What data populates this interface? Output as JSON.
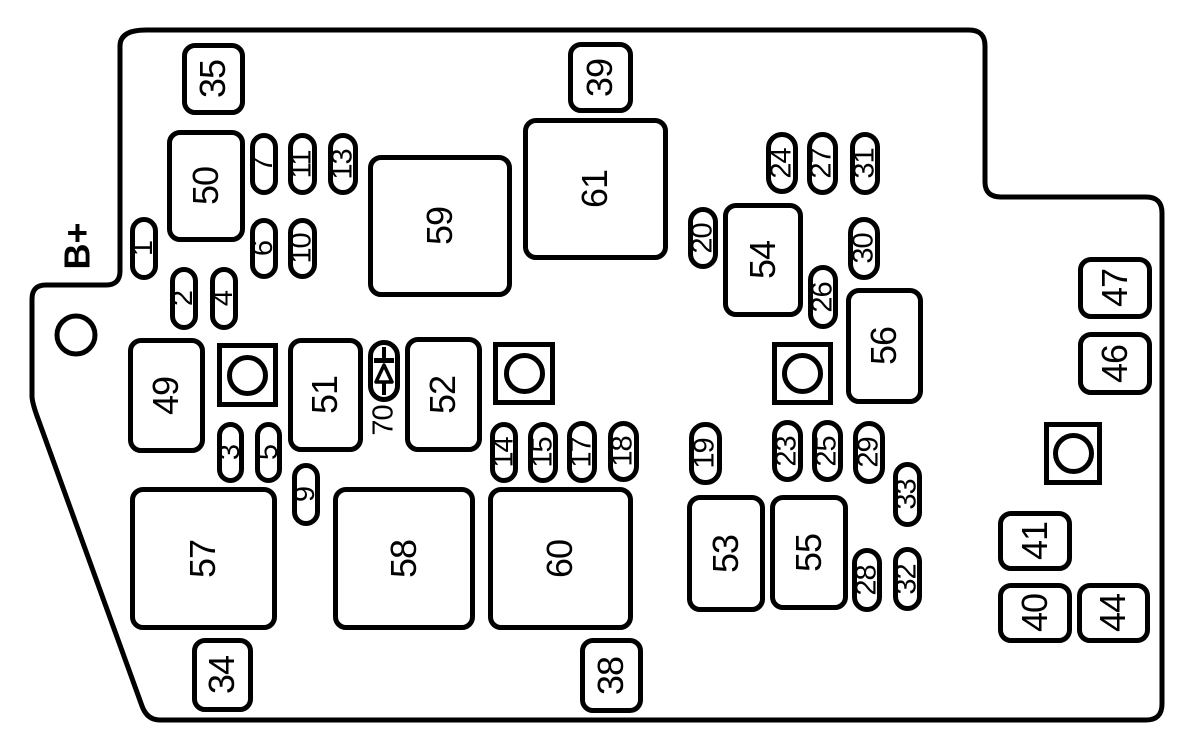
{
  "diagram": {
    "kind": "engine-compartment-fuse-box",
    "battery_terminal_label": "B+",
    "diode": {
      "label": "70",
      "symbol": "diode-icon"
    },
    "colors": {
      "line": "#000000",
      "background": "#ffffff"
    },
    "relays": [
      {
        "id": "35",
        "x": 182,
        "y": 43,
        "w": 63,
        "h": 72
      },
      {
        "id": "50",
        "x": 167,
        "y": 130,
        "w": 78,
        "h": 112
      },
      {
        "id": "39",
        "x": 568,
        "y": 42,
        "w": 65,
        "h": 71
      },
      {
        "id": "61",
        "x": 523,
        "y": 118,
        "w": 145,
        "h": 142
      },
      {
        "id": "59",
        "x": 368,
        "y": 155,
        "w": 144,
        "h": 142
      },
      {
        "id": "54",
        "x": 723,
        "y": 203,
        "w": 80,
        "h": 114
      },
      {
        "id": "56",
        "x": 846,
        "y": 288,
        "w": 77,
        "h": 116
      },
      {
        "id": "47",
        "x": 1078,
        "y": 257,
        "w": 74,
        "h": 62
      },
      {
        "id": "46",
        "x": 1078,
        "y": 332,
        "w": 74,
        "h": 63
      },
      {
        "id": "49",
        "x": 128,
        "y": 338,
        "w": 77,
        "h": 115
      },
      {
        "id": "51",
        "x": 288,
        "y": 338,
        "w": 75,
        "h": 114
      },
      {
        "id": "52",
        "x": 405,
        "y": 337,
        "w": 77,
        "h": 115
      },
      {
        "id": "57",
        "x": 130,
        "y": 487,
        "w": 147,
        "h": 143
      },
      {
        "id": "58",
        "x": 333,
        "y": 487,
        "w": 142,
        "h": 143
      },
      {
        "id": "60",
        "x": 488,
        "y": 487,
        "w": 145,
        "h": 143
      },
      {
        "id": "53",
        "x": 687,
        "y": 495,
        "w": 78,
        "h": 117
      },
      {
        "id": "55",
        "x": 770,
        "y": 495,
        "w": 78,
        "h": 115
      },
      {
        "id": "34",
        "x": 192,
        "y": 638,
        "w": 61,
        "h": 74
      },
      {
        "id": "38",
        "x": 580,
        "y": 638,
        "w": 63,
        "h": 75
      },
      {
        "id": "41",
        "x": 998,
        "y": 511,
        "w": 74,
        "h": 60
      },
      {
        "id": "40",
        "x": 998,
        "y": 583,
        "w": 74,
        "h": 60
      },
      {
        "id": "44",
        "x": 1077,
        "y": 583,
        "w": 73,
        "h": 60
      }
    ],
    "fuses": [
      {
        "id": "1",
        "x": 130,
        "y": 217,
        "w": 28,
        "h": 63
      },
      {
        "id": "2",
        "x": 170,
        "y": 267,
        "w": 28,
        "h": 63
      },
      {
        "id": "4",
        "x": 210,
        "y": 267,
        "w": 28,
        "h": 63
      },
      {
        "id": "7",
        "x": 250,
        "y": 133,
        "w": 28,
        "h": 62
      },
      {
        "id": "11",
        "x": 288,
        "y": 133,
        "w": 29,
        "h": 62
      },
      {
        "id": "13",
        "x": 328,
        "y": 133,
        "w": 30,
        "h": 62
      },
      {
        "id": "6",
        "x": 250,
        "y": 218,
        "w": 28,
        "h": 61
      },
      {
        "id": "10",
        "x": 288,
        "y": 218,
        "w": 29,
        "h": 61
      },
      {
        "id": "3",
        "x": 217,
        "y": 422,
        "w": 27,
        "h": 61
      },
      {
        "id": "5",
        "x": 255,
        "y": 422,
        "w": 27,
        "h": 61
      },
      {
        "id": "9",
        "x": 292,
        "y": 463,
        "w": 28,
        "h": 63
      },
      {
        "id": "14",
        "x": 490,
        "y": 422,
        "w": 28,
        "h": 61
      },
      {
        "id": "15",
        "x": 528,
        "y": 422,
        "w": 30,
        "h": 61
      },
      {
        "id": "17",
        "x": 567,
        "y": 421,
        "w": 30,
        "h": 62
      },
      {
        "id": "18",
        "x": 608,
        "y": 421,
        "w": 31,
        "h": 61
      },
      {
        "id": "19",
        "x": 689,
        "y": 422,
        "w": 33,
        "h": 63
      },
      {
        "id": "20",
        "x": 688,
        "y": 207,
        "w": 30,
        "h": 62
      },
      {
        "id": "24",
        "x": 766,
        "y": 132,
        "w": 32,
        "h": 62
      },
      {
        "id": "27",
        "x": 807,
        "y": 132,
        "w": 31,
        "h": 63
      },
      {
        "id": "31",
        "x": 850,
        "y": 132,
        "w": 30,
        "h": 63
      },
      {
        "id": "30",
        "x": 848,
        "y": 217,
        "w": 32,
        "h": 63
      },
      {
        "id": "26",
        "x": 808,
        "y": 265,
        "w": 30,
        "h": 64
      },
      {
        "id": "23",
        "x": 772,
        "y": 420,
        "w": 31,
        "h": 62
      },
      {
        "id": "25",
        "x": 812,
        "y": 420,
        "w": 31,
        "h": 62
      },
      {
        "id": "29",
        "x": 853,
        "y": 421,
        "w": 32,
        "h": 63
      },
      {
        "id": "33",
        "x": 893,
        "y": 462,
        "w": 29,
        "h": 65
      },
      {
        "id": "28",
        "x": 852,
        "y": 548,
        "w": 30,
        "h": 64
      },
      {
        "id": "32",
        "x": 893,
        "y": 547,
        "w": 29,
        "h": 64
      }
    ],
    "studs": [
      {
        "id": "1",
        "x": 217,
        "y": 343,
        "w": 61,
        "h": 64
      },
      {
        "id": "2",
        "x": 493,
        "y": 342,
        "w": 62,
        "h": 63
      },
      {
        "id": "3",
        "x": 772,
        "y": 342,
        "w": 61,
        "h": 63
      },
      {
        "id": "4",
        "x": 1044,
        "y": 422,
        "w": 58,
        "h": 63
      }
    ],
    "mounting_hole": {
      "cx": 76,
      "cy": 335,
      "r": 19
    }
  }
}
